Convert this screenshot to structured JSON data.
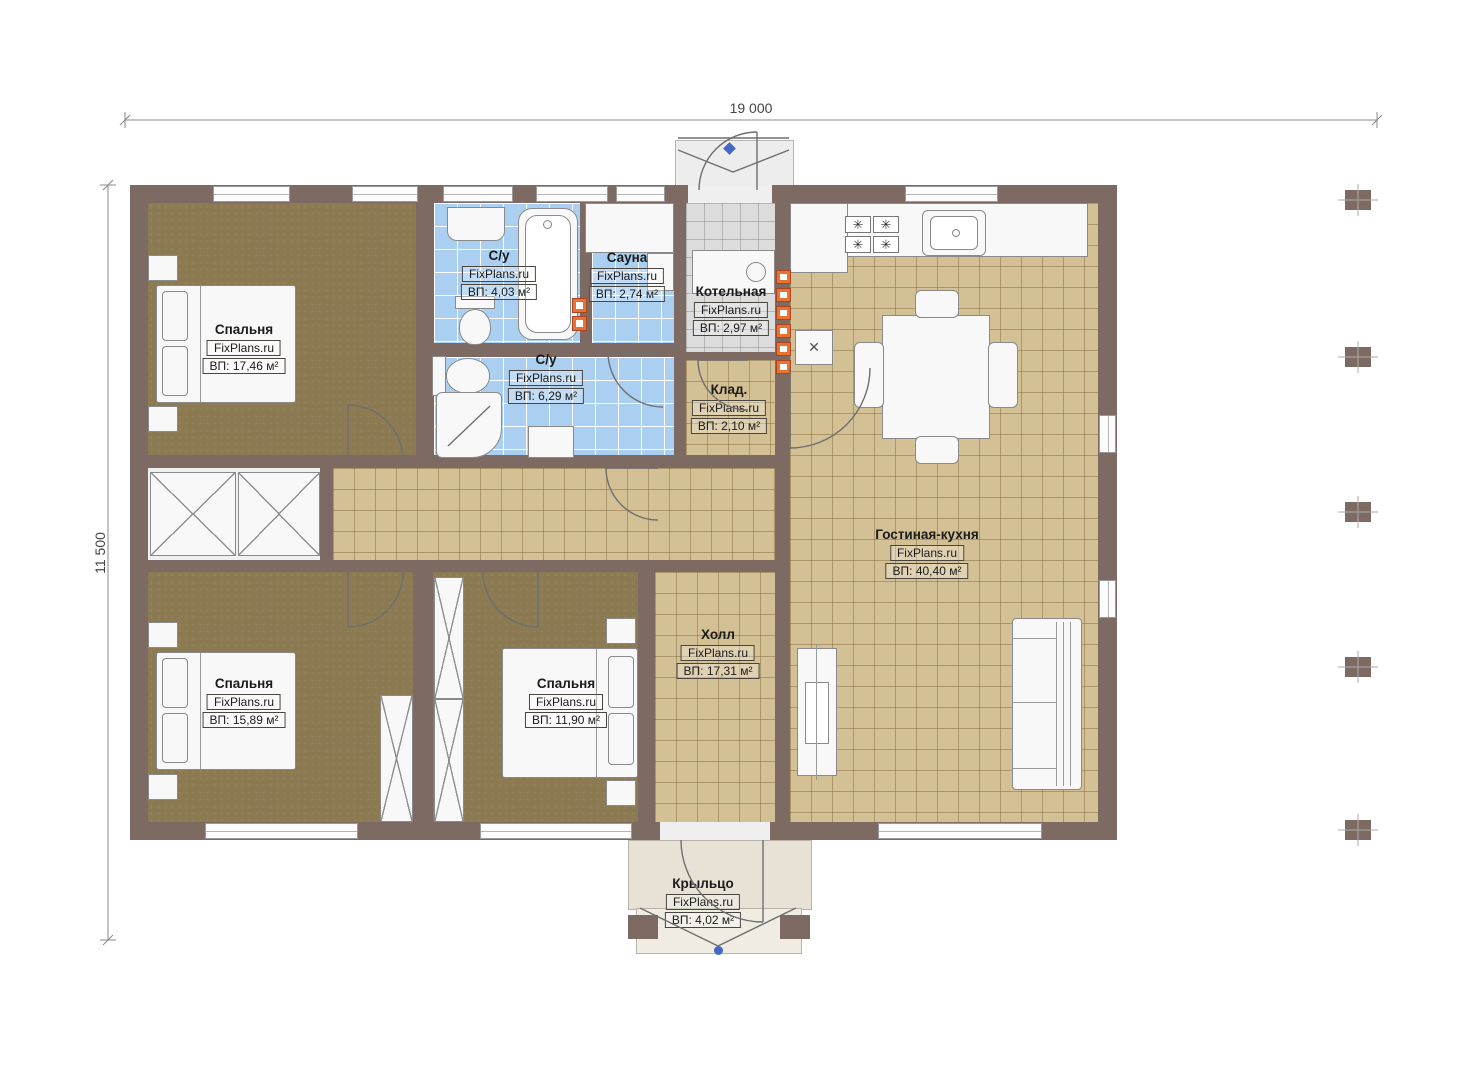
{
  "plan_title": "Одноэтажный дом — план этажа",
  "brand": "FixPlans.ru",
  "dimensions": {
    "top": "19 000",
    "left": "11 500"
  },
  "rooms": [
    {
      "id": "bedroom-top-left",
      "name": "Спальня",
      "area": "ВП: 17,46 м²"
    },
    {
      "id": "bathroom-top",
      "name": "С/у",
      "area": "ВП: 4,03 м²"
    },
    {
      "id": "sauna",
      "name": "Сауна",
      "area": "ВП: 2,74 м²"
    },
    {
      "id": "boiler-room",
      "name": "Котельная",
      "area": "ВП: 2,97 м²"
    },
    {
      "id": "bathroom-main",
      "name": "С/у",
      "area": "ВП: 6,29 м²"
    },
    {
      "id": "storage",
      "name": "Клад.",
      "area": "ВП: 2,10 м²"
    },
    {
      "id": "living-kitchen",
      "name": "Гостиная-кухня",
      "area": "ВП: 40,40 м²"
    },
    {
      "id": "hall",
      "name": "Холл",
      "area": "ВП: 17,31 м²"
    },
    {
      "id": "bedroom-bottom-left",
      "name": "Спальня",
      "area": "ВП: 15,89 м²"
    },
    {
      "id": "bedroom-bottom-mid",
      "name": "Спальня",
      "area": "ВП: 11,90 м²"
    },
    {
      "id": "porch",
      "name": "Крыльцо",
      "area": "ВП: 4,02 м²"
    }
  ],
  "colors": {
    "wall": "#7d6a62",
    "bedroom_floor": "#8b7a52",
    "tile_blue": "#aacff0",
    "tile_beige": "#d3c094",
    "tile_gray": "#dcdcdc",
    "porch_floor": "#e8e1d5",
    "accent_orange": "#e87230",
    "marker_blue": "#4468c8"
  }
}
